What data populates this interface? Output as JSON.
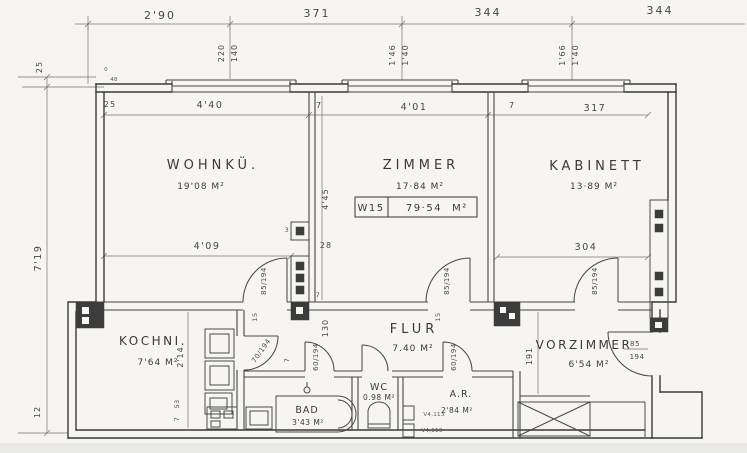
{
  "palette": {
    "paper": "#f6f5f1",
    "ink": "#3a3a3a",
    "dim_ink": "#5c5c5c",
    "scan_strip": "#e8e8e5"
  },
  "unit_box": {
    "code": "W15",
    "area": "79·54",
    "unit": "M²"
  },
  "rooms": {
    "wohnku": {
      "name": "WOHNKÜ.",
      "area": "19'08 M²"
    },
    "zimmer": {
      "name": "ZIMMER",
      "area": "17·84 M²"
    },
    "kabinett": {
      "name": "KABINETT",
      "area": "13·89 M²"
    },
    "kochni": {
      "name": "KOCHNI.",
      "area": "7'64 M²"
    },
    "flur": {
      "name": "FLUR",
      "area": "7.40 M²"
    },
    "bad": {
      "name": "BAD",
      "area": "3'43 M²"
    },
    "wc": {
      "name": "WC",
      "area": "0.98 M²"
    },
    "ar": {
      "name": "A.R.",
      "area": "2'84 M²"
    },
    "vorzimmer": {
      "name": "VORZIMMER",
      "area": "6'54 M²"
    }
  },
  "dims": {
    "top": [
      "2'90",
      "371",
      "344",
      "344"
    ],
    "win1": [
      "220",
      "140"
    ],
    "win2": [
      "1'46",
      "1'40"
    ],
    "win3": [
      "1'66",
      "1'40"
    ],
    "left": [
      "25",
      "7'19",
      "12"
    ],
    "inner_top": [
      "25",
      "4'40",
      "7",
      "4'01",
      "7",
      "317"
    ],
    "mid": {
      "d409": "4'09",
      "d28": "28",
      "d445": "4'45",
      "d3": "3",
      "d7a": "7",
      "d130": "130",
      "d7b": "7",
      "d304": "304",
      "d191": "191",
      "d214": "2'14",
      "d53": "53",
      "d7c": "7",
      "d15a": "15",
      "d15b": "15",
      "d48": "48",
      "d0": "0"
    }
  },
  "doors": {
    "wohnku": "85/194",
    "zimmer": "85/194",
    "kabinett": "85/194",
    "kochni": "70/194",
    "bad": "60/194",
    "ar": "60/194",
    "entrance_num": "85",
    "entrance_den": "194"
  },
  "annotations": {
    "v1": "V4,113",
    "v2": "V4,113"
  }
}
